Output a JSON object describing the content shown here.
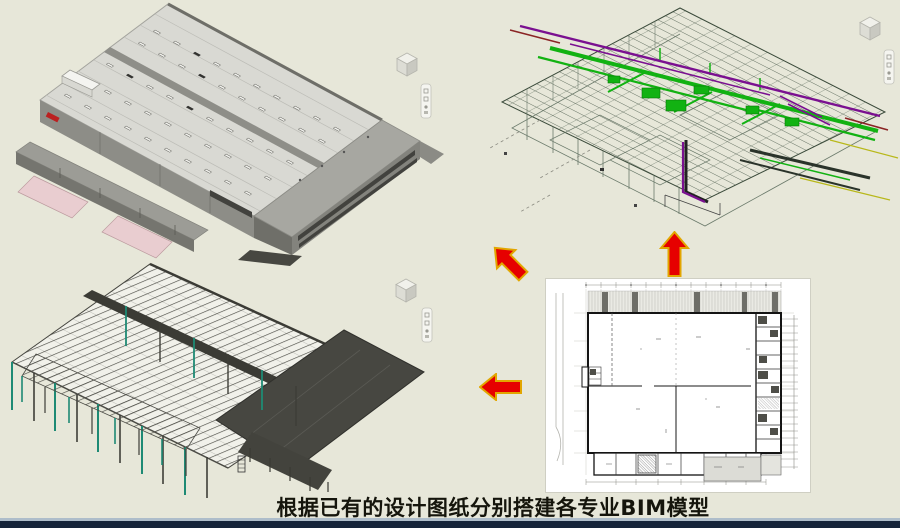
{
  "slide": {
    "caption": "根据已有的设计图纸分别搭建各专业BIM模型"
  },
  "views": {
    "architecture": "architecture BIM model (3D building, gray roof, pink dock ramps)",
    "mep": "MEP BIM model (green ducts, purple pipes, wireframe)",
    "structure": "structural steel BIM model (dark frame, teal columns)",
    "floor_plan": "2D design drawing floor plan on white sheet"
  },
  "icons": {
    "viewcube": "viewcube-icon",
    "nav_toolbar": "navigation-toolbar-icon",
    "arrow_up": "arrow-up-icon",
    "arrow_up_left": "arrow-up-left-icon",
    "arrow_left": "arrow-left-icon"
  },
  "colors": {
    "background": "#e7e7d9",
    "caption": "#15150c",
    "footer_line": "#aebdca",
    "footer_bar": "#15243a",
    "arrow_red": "#e60000",
    "arrow_outline": "#e2a600",
    "mep_green": "#12b212",
    "mep_purple": "#7a1090",
    "struct_teal": "#1e8a74",
    "ramp_pink": "#e9cdd0",
    "plan_paper": "#ffffff"
  }
}
